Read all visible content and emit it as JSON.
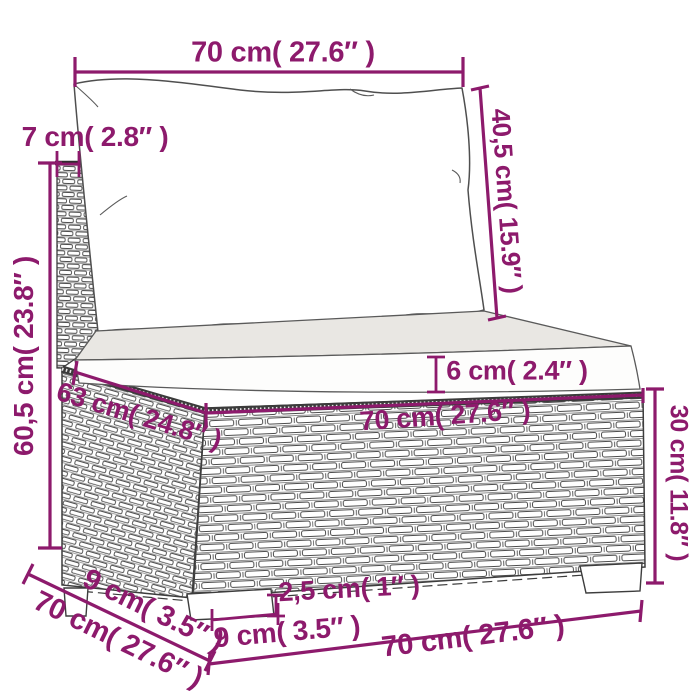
{
  "title": "Rattan sofa section dimension diagram",
  "colors": {
    "accent": "#8d1a6c",
    "line": "#3a3a3a",
    "cushion_top": "#e9e7e3",
    "background": "#ffffff"
  },
  "dimensions": {
    "top_width": {
      "label": "70 cm( 27.6″ )"
    },
    "back_thickness": {
      "label": "7 cm( 2.8″ )"
    },
    "total_height": {
      "label": "60,5 cm( 23.8″ )"
    },
    "backrest_height": {
      "label": "40,5 cm( 15.9″ )"
    },
    "cushion_height": {
      "label": "6 cm( 2.4″ )"
    },
    "seat_width": {
      "label": "70 cm( 27.6″ )"
    },
    "seat_depth": {
      "label": "63 cm( 24.8″ )"
    },
    "base_height": {
      "label": "30 cm( 11.8″ )"
    },
    "bottom_width": {
      "label": "70 cm( 27.6″ )"
    },
    "depth_total": {
      "label": "70 cm( 27.6″ )"
    },
    "foot_inset": {
      "label": "9 cm( 3.5″ )"
    },
    "foot_width": {
      "label": "9 cm( 3.5″ )"
    },
    "foot_height": {
      "label": "2,5 cm( 1″ )"
    }
  }
}
